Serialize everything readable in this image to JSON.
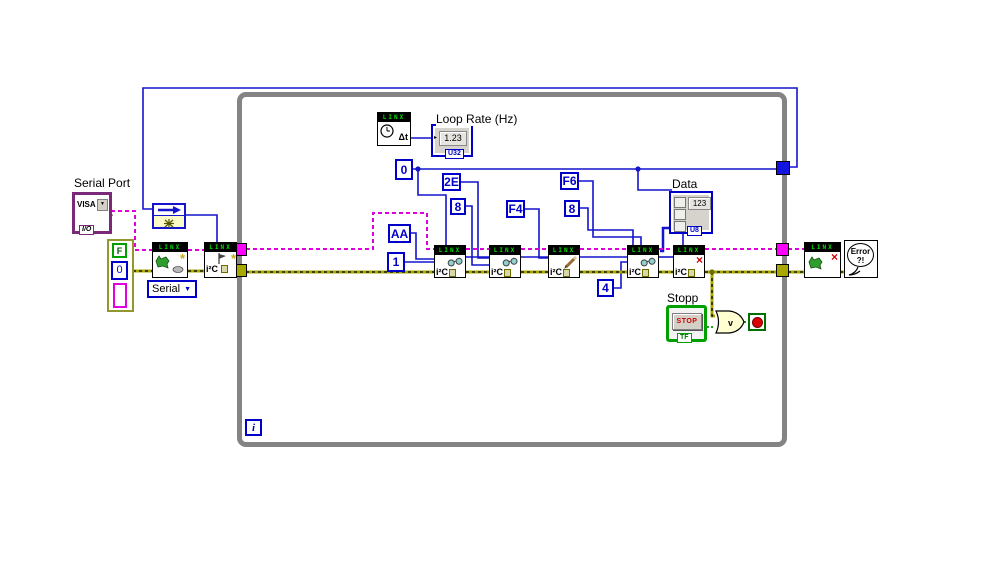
{
  "app": "LabVIEW block diagram",
  "labels": {
    "serial_port": "Serial Port",
    "loop_rate": "Loop Rate (Hz)",
    "data": "Data",
    "stopp": "Stopp"
  },
  "visa_control": {
    "text": "VISA",
    "type_tag": "I/O"
  },
  "error_cluster": {
    "bool": "F",
    "code": "0"
  },
  "linx_open": {
    "banner": "LINX",
    "dropdown_value": "Serial"
  },
  "i2c_open": {
    "banner": "LINX",
    "label": "i²C"
  },
  "wait_node": {
    "banner": "LINX",
    "label": "Δt"
  },
  "loop_rate_indicator": {
    "value": "1.23",
    "type_tag": "U32"
  },
  "data_indicator": {
    "value": "123",
    "type_tag": "U8"
  },
  "constants": {
    "channel": "0",
    "reg_2e": "2E",
    "len_8a": "8",
    "reg_f4": "F4",
    "reg_f6": "F6",
    "len_8b": "8",
    "addr_aa": "AA",
    "num_1": "1",
    "num_4": "4"
  },
  "i2c_nodes": [
    {
      "banner": "LINX",
      "label": "i²C",
      "icon": "glasses"
    },
    {
      "banner": "LINX",
      "label": "i²C",
      "icon": "glasses"
    },
    {
      "banner": "LINX",
      "label": "i²C",
      "icon": "pencil"
    },
    {
      "banner": "LINX",
      "label": "i²C",
      "icon": "glasses"
    },
    {
      "banner": "LINX",
      "label": "i²C",
      "icon": "close-x"
    }
  ],
  "loop": {
    "iteration": "i"
  },
  "stop_section": {
    "label": "Stopp",
    "button": "STOP",
    "type_tag": "TF",
    "or_symbol": "v"
  },
  "linx_close": {
    "banner": "LINX"
  },
  "error_handler": {
    "line1": "Error",
    "line2": "?!"
  },
  "colors": {
    "wire_blue": "#1414cc",
    "wire_visa_pink": "#dd00dd",
    "wire_error_olive": "#a8a800",
    "wire_bool_green": "#009900",
    "loop_border": "#848484",
    "banner_text": "#00e000",
    "const_blue": "#0000c8",
    "visa_purple": "#7a2878",
    "stop_green": "#007000",
    "stop_red": "#d40000"
  }
}
